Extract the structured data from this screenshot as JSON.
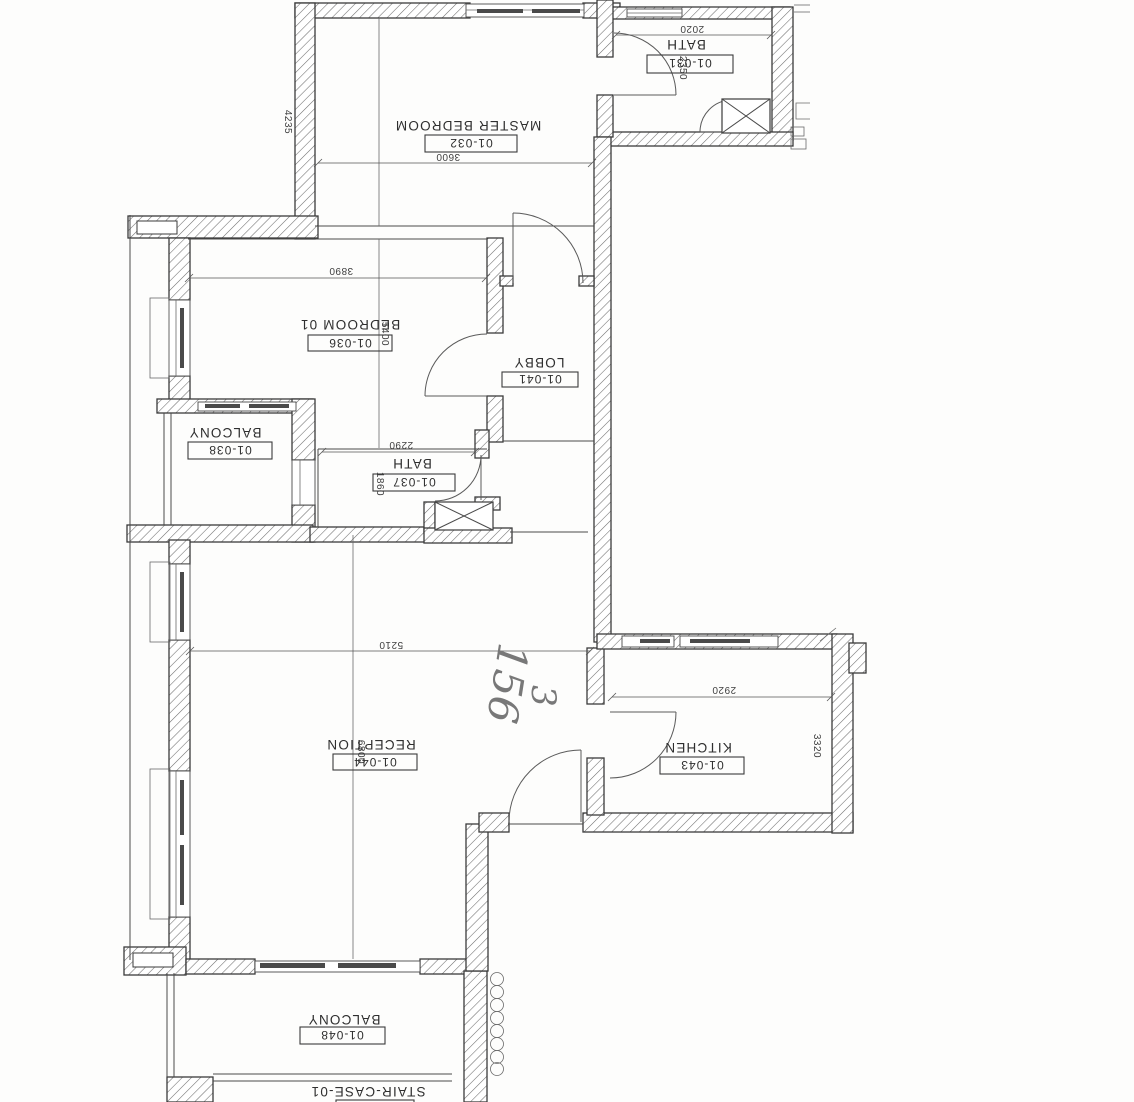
{
  "drawing": {
    "type": "floor-plan",
    "orientation": "rotated-180",
    "rooms": {
      "bath_top": {
        "label": "BATH",
        "code": "01-031"
      },
      "master": {
        "label": "MASTER BEDROOM",
        "code": "01-032"
      },
      "bedroom01": {
        "label": "BEDROOM 01",
        "code": "01-036"
      },
      "lobby": {
        "label": "LOBBY",
        "code": "01-041"
      },
      "balcony_upper": {
        "label": "BALCONY",
        "code": "01-038"
      },
      "bath_mid": {
        "label": "BATH",
        "code": "01-037"
      },
      "reception": {
        "label": "RECEPTION",
        "code": "01-044"
      },
      "kitchen": {
        "label": "KITCHEN",
        "code": "01-043"
      },
      "balcony_lower": {
        "label": "BALCONY",
        "code": "01-048"
      },
      "staircase": {
        "label": "STAIR-CASE-01"
      }
    },
    "dims": {
      "bath_top_w": "2020",
      "bath_top_h": "2350",
      "master_w": "3600",
      "master_h": "4235",
      "bedroom01_w": "3890",
      "bedroom01_h": "5400",
      "bath_mid_w": "2290",
      "bath_mid_h": "1860",
      "reception_w": "5210",
      "reception_h": "6800",
      "kitchen_w": "2920",
      "kitchen_h": "3320"
    },
    "handwriting": {
      "value1": "156",
      "value2": "3"
    },
    "colors": {
      "line": "#3b3b3b",
      "paper": "#fdfdfc",
      "pencil": "#787878"
    }
  }
}
